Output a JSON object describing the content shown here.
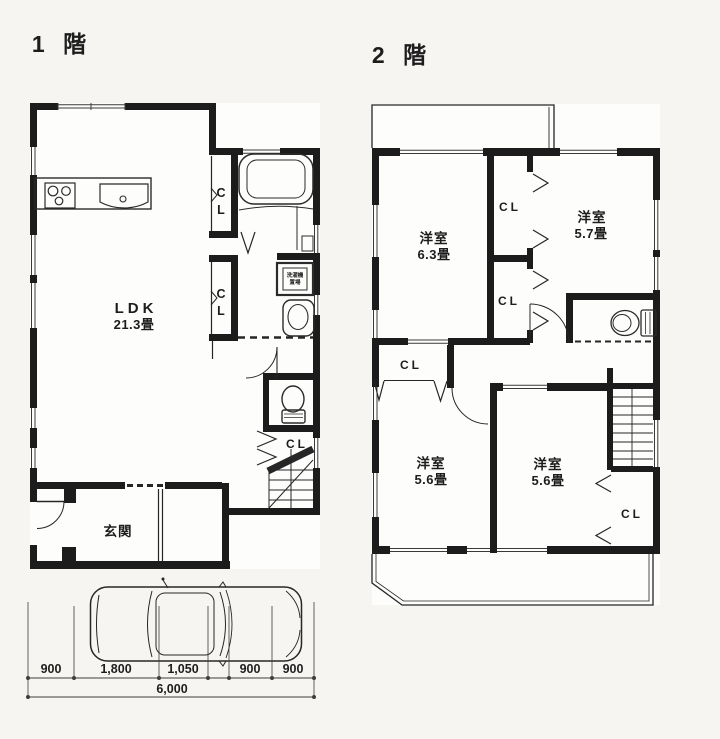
{
  "titles": {
    "floor1": "1 階",
    "floor2": "2 階"
  },
  "floor1": {
    "ldk": {
      "name": "LDK",
      "size": "21.3畳"
    },
    "genkan_label": "玄関",
    "closet_upper": [
      "C",
      "L"
    ],
    "closet_mid": [
      "C",
      "L"
    ],
    "closet_stairs": "CL",
    "washer_label": [
      "洗濯機",
      "置場"
    ]
  },
  "floor2": {
    "room_63": {
      "name": "洋室",
      "size": "6.3畳"
    },
    "room_57": {
      "name": "洋室",
      "size": "5.7畳"
    },
    "room_56_left": {
      "name": "洋室",
      "size": "5.6畳"
    },
    "room_56_right": {
      "name": "洋室",
      "size": "5.6畳"
    },
    "closet_top": "CL",
    "closet_mid": "CL",
    "closet_hall": "CL",
    "closet_right": "CL"
  },
  "dimensions": {
    "segments": [
      "900",
      "1,800",
      "1,050",
      "900",
      "900"
    ],
    "total": "6,000"
  },
  "ink_color": "#1f1f1f",
  "paper_color": "#f6f5f2"
}
